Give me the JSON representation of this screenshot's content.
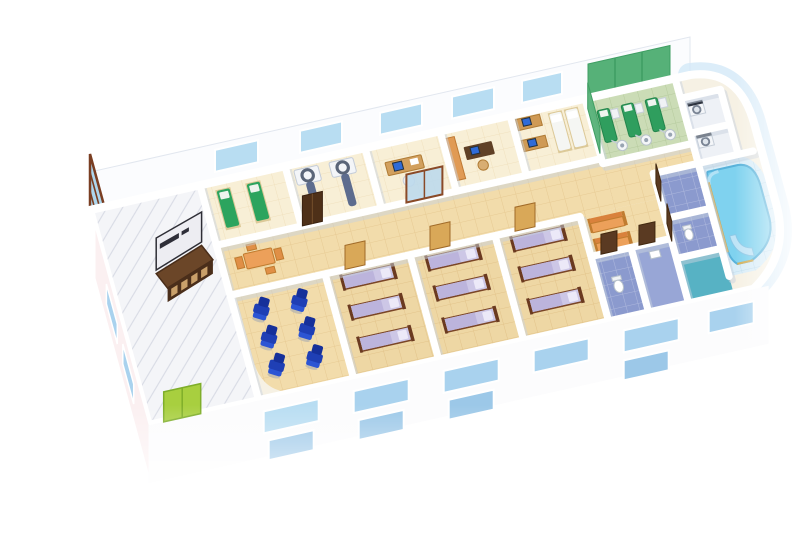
{
  "scene": {
    "title": "Cutaway 3D isometric floor plan of a clinic / hospital storey on a white background",
    "building": {
      "view": "axonometric cutaway, long axis running from lower-left to upper-right",
      "walls": "white",
      "rounded_right_end": true,
      "lower_storey_facade": "white wall with two rows of light-blue windows, fading to white at the bottom"
    },
    "rooms": [
      {
        "name": "entrance-lobby",
        "floor": "white tile",
        "features": [
          "glass curtain wall with brown frame",
          "dark reception counter with 4 panel inlays",
          "reception sign board (text illegible)",
          "green double entrance door"
        ]
      },
      {
        "name": "exam-room-green-beds",
        "furniture": {
          "green_treatment_beds": 2
        }
      },
      {
        "name": "imaging-room",
        "furniture": {
          "ct_scanners_with_tables": 2
        }
      },
      {
        "name": "doctor-office",
        "furniture": {
          "wood_desk": 1,
          "computer": 1,
          "chair": 1
        }
      },
      {
        "name": "staff-office",
        "furniture": {
          "dark_desk": 1,
          "computer": 1,
          "orange_sideboard": 1
        }
      },
      {
        "name": "consult-room",
        "furniture": {
          "desks_with_computers": 2,
          "white_exam_beds": 2
        }
      },
      {
        "name": "operating-theater",
        "floor": "pale green",
        "furniture": {
          "green_operating_tables": 3,
          "overhead_lamps": 3,
          "green_wall_panels": true
        }
      },
      {
        "name": "utility-room",
        "furniture": {
          "white_sterilizer_machines": 2
        }
      },
      {
        "name": "hydrotherapy-pool-room",
        "features": [
          "curved blue pool",
          "curved seat",
          "gold rail",
          "curved glass outer wall"
        ]
      },
      {
        "name": "shower-toilet-cells",
        "floors": [
          "periwinkle",
          "periwinkle",
          "teal"
        ]
      },
      {
        "name": "corridor",
        "furniture": {
          "wood_table_with_chairs": 1,
          "dark_double_door": 1,
          "orange_benches": 2,
          "ward_doors": 3
        }
      },
      {
        "name": "recliner-room",
        "furniture": {
          "blue_recliner_chairs": 6
        }
      },
      {
        "name": "patient-ward-1",
        "furniture": {
          "wood_beds_lavender_bedding": 3
        }
      },
      {
        "name": "patient-ward-2",
        "furniture": {
          "wood_beds_lavender_bedding": 3
        }
      },
      {
        "name": "patient-ward-3",
        "furniture": {
          "wood_beds_lavender_bedding": 3
        }
      },
      {
        "name": "bathrooms",
        "furniture": {
          "toilets": 2,
          "basin": 1
        }
      }
    ],
    "reception_sign": {
      "legible": false
    }
  },
  "colors": {
    "background": "#ffffff",
    "wall_white": "#fdfdfe",
    "corridor_tile": "#f2dcab",
    "ward_tile": "#eed7a4",
    "lobby_tile": "#f4f5f8",
    "ot_floor": "#cbdcb6",
    "ot_green": "#2f9e5e",
    "pool_water": "#7fd2ef",
    "pool_deck": "#d9edf8",
    "glass_blue": "#a6d2ec",
    "window_blue": "#b8ddf2",
    "chair_blue": "#1f3fb5",
    "bed_mattress": "#cdc7e6",
    "bed_wood": "#6b3a20",
    "desk_wood": "#d2a05e",
    "bench_orange": "#eca05a",
    "counter_dark": "#4a2e1a",
    "door_green": "#a8cf3f",
    "door_tan": "#d9a858",
    "door_dark": "#4e3018",
    "periwinkle_floor": "#8b9ace",
    "teal_floor": "#57b2c4",
    "scanner_table": "#5d6c8e",
    "monitor_screen": "#2f6bd8"
  }
}
